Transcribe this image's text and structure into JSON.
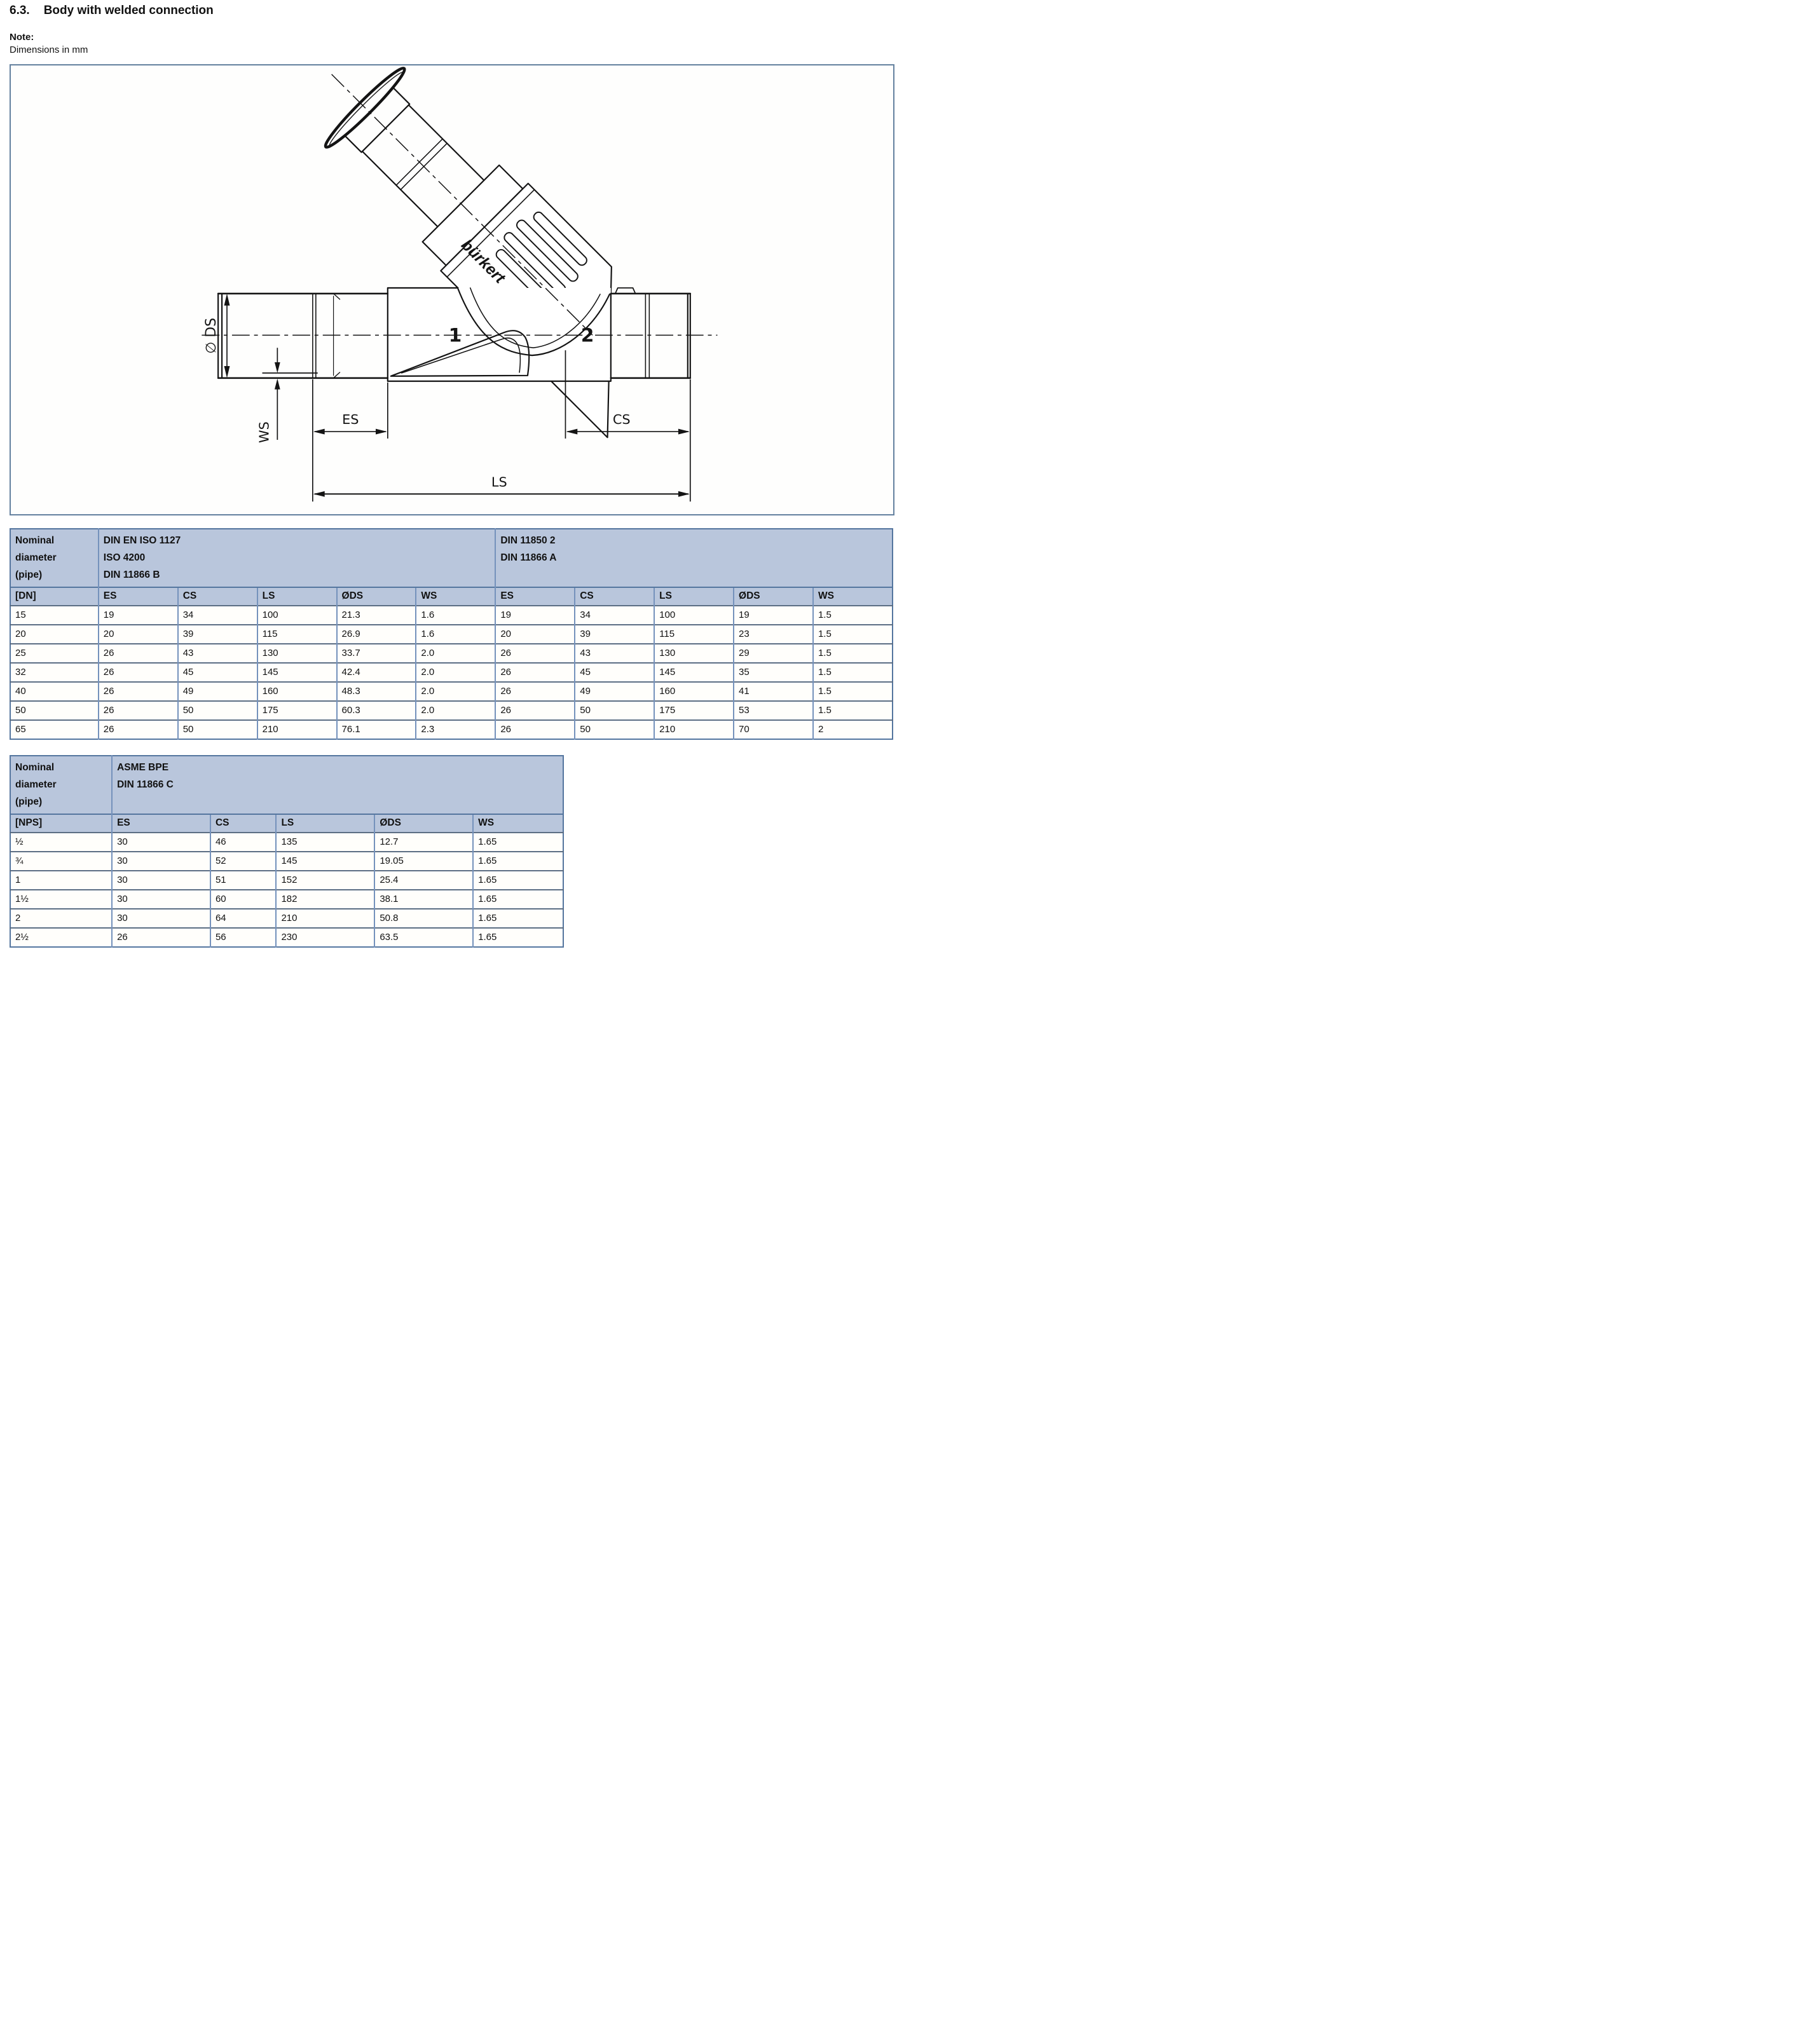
{
  "page": {
    "section_number": "6.3.",
    "section_title": "Body with welded connection",
    "note_label": "Note:",
    "note_text": "Dimensions in mm"
  },
  "diagram": {
    "labels": {
      "diameter": "∅ DS",
      "ws": "WS",
      "es": "ES",
      "cs": "CS",
      "ls": "LS",
      "port1": "1",
      "port2": "2",
      "brand": "bürkert"
    }
  },
  "tables": [
    {
      "corner": "Nominal\ndiameter\n(pipe)",
      "groups": [
        {
          "label": "DIN EN ISO 1127\nISO 4200\nDIN 11866 B"
        },
        {
          "label": "DIN 11850 2\nDIN 11866 A"
        }
      ],
      "key_header": "[DN]",
      "columns": [
        "ES",
        "CS",
        "LS",
        "ØDS",
        "WS",
        "ES",
        "CS",
        "LS",
        "ØDS",
        "WS"
      ],
      "rows": [
        [
          "15",
          "19",
          "34",
          "100",
          "21.3",
          "1.6",
          "19",
          "34",
          "100",
          "19",
          "1.5"
        ],
        [
          "20",
          "20",
          "39",
          "115",
          "26.9",
          "1.6",
          "20",
          "39",
          "115",
          "23",
          "1.5"
        ],
        [
          "25",
          "26",
          "43",
          "130",
          "33.7",
          "2.0",
          "26",
          "43",
          "130",
          "29",
          "1.5"
        ],
        [
          "32",
          "26",
          "45",
          "145",
          "42.4",
          "2.0",
          "26",
          "45",
          "145",
          "35",
          "1.5"
        ],
        [
          "40",
          "26",
          "49",
          "160",
          "48.3",
          "2.0",
          "26",
          "49",
          "160",
          "41",
          "1.5"
        ],
        [
          "50",
          "26",
          "50",
          "175",
          "60.3",
          "2.0",
          "26",
          "50",
          "175",
          "53",
          "1.5"
        ],
        [
          "65",
          "26",
          "50",
          "210",
          "76.1",
          "2.3",
          "26",
          "50",
          "210",
          "70",
          "2"
        ]
      ]
    },
    {
      "corner": "Nominal\ndiameter\n(pipe)",
      "groups": [
        {
          "label": "ASME BPE\nDIN 11866 C"
        }
      ],
      "key_header": "[NPS]",
      "columns": [
        "ES",
        "CS",
        "LS",
        "ØDS",
        "WS"
      ],
      "rows": [
        [
          "½",
          "30",
          "46",
          "135",
          "12.7",
          "1.65"
        ],
        [
          "¾",
          "30",
          "52",
          "145",
          "19.05",
          "1.65"
        ],
        [
          "1",
          "30",
          "51",
          "152",
          "25.4",
          "1.65"
        ],
        [
          "1½",
          "30",
          "60",
          "182",
          "38.1",
          "1.65"
        ],
        [
          "2",
          "30",
          "64",
          "210",
          "50.8",
          "1.65"
        ],
        [
          "2½",
          "26",
          "56",
          "230",
          "63.5",
          "1.65"
        ]
      ]
    }
  ]
}
